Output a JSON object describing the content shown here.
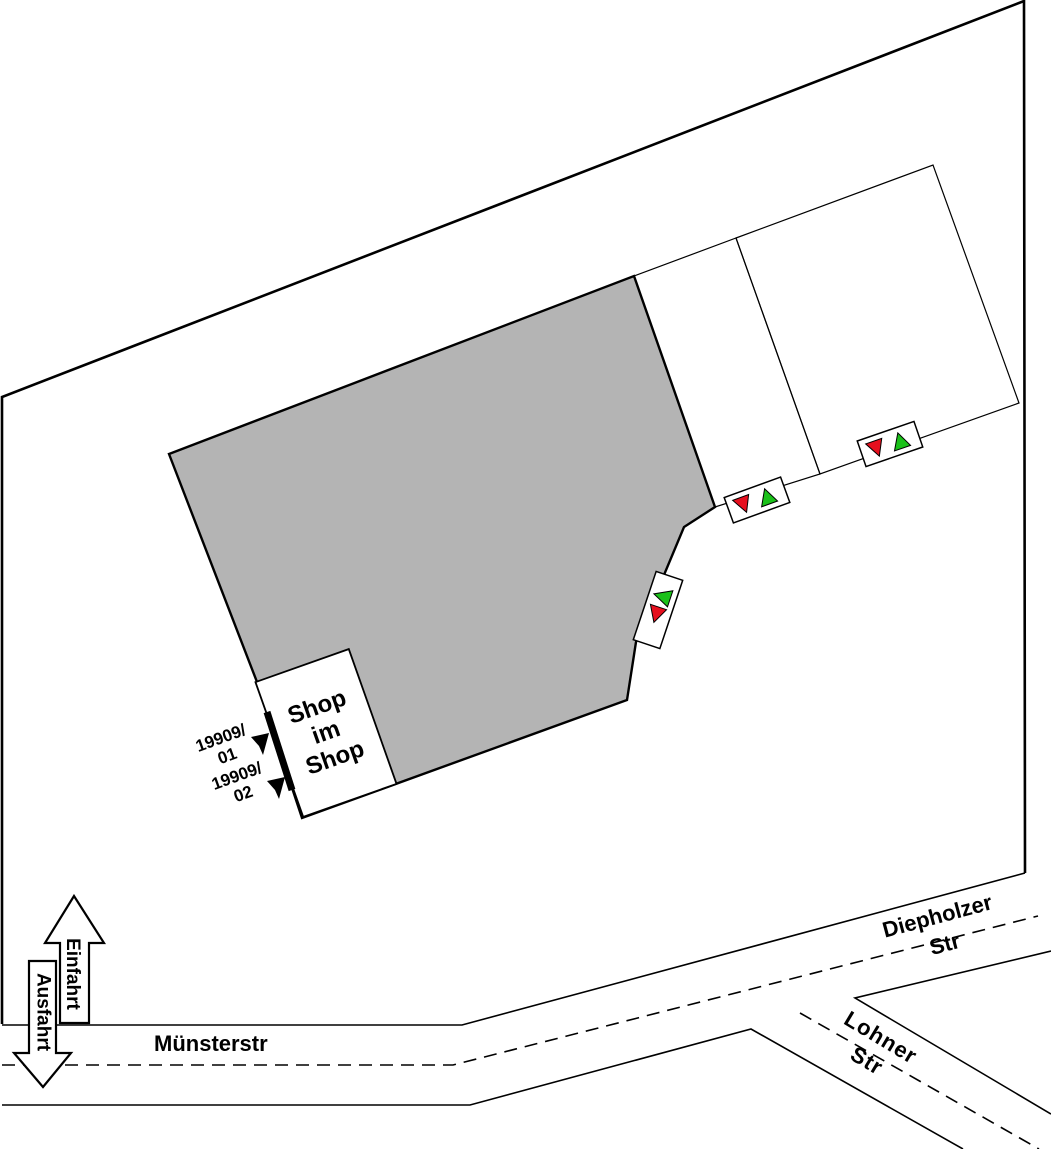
{
  "canvas": {
    "width": 1051,
    "height": 1149,
    "background": "#ffffff"
  },
  "colors": {
    "line": "#000000",
    "building_fill": "#b4b4b4",
    "marker_red": "#e60f1e",
    "marker_green": "#1ac119",
    "marker_box_fill": "#ffffff"
  },
  "streets": {
    "muensterstr": "Münsterstr",
    "diepholzer_line1": "Diepholzer",
    "diepholzer_line2": "Str",
    "lohner_line1": "Lohner",
    "lohner_line2": "Str"
  },
  "access": {
    "entrance_label": "Einfahrt",
    "exit_label": "Ausfahrt"
  },
  "building": {
    "shop_line1": "Shop",
    "shop_line2": "im",
    "shop_line3": "Shop"
  },
  "positions": [
    {
      "line1": "19909/",
      "line2": "01"
    },
    {
      "line1": "19909/",
      "line2": "02"
    }
  ],
  "markers": [
    {
      "name": "parcel-marker-east",
      "symbols": [
        "red-triangle-down",
        "green-triangle-up"
      ]
    },
    {
      "name": "parcel-marker-west",
      "symbols": [
        "red-triangle-down",
        "green-triangle-up"
      ]
    },
    {
      "name": "building-edge-marker",
      "symbols": [
        "green-triangle-left",
        "red-triangle-down"
      ]
    }
  ]
}
